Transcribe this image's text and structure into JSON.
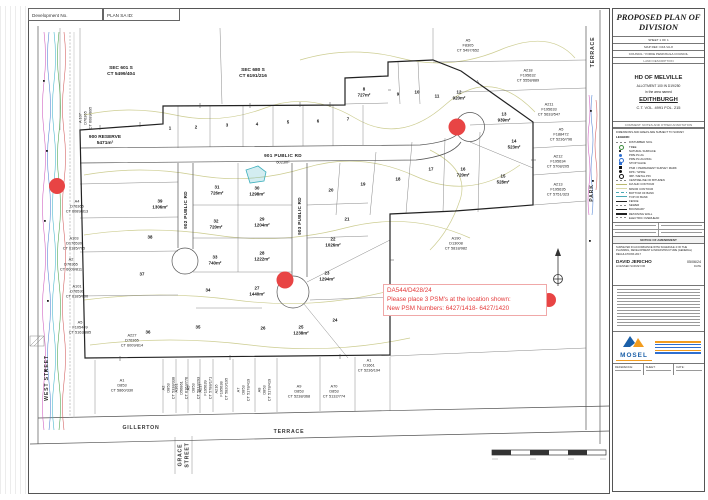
{
  "document": {
    "dev_no_label": "Development No.",
    "plan_sa_id_label": "PLAN SA ID:"
  },
  "annotation": {
    "line1": "DA544/D428/24",
    "line2": "Please place 3 PSM's at the location shown:",
    "line3": "New PSM Numbers: 6427/1418- 6427/1420"
  },
  "colors": {
    "psm_marker_red": "#e84444",
    "water_feature_teal": "#3fb0bd",
    "contour_olive": "#c9c98a",
    "mosel_blue": "#1a5fa8",
    "mosel_orange": "#f29c1f"
  },
  "plan": {
    "sections": {
      "sec601": "SEC 601 S\nCT 5499/404",
      "sec680": "SEC 680 S\nCT 6191/216",
      "reserve": "900 RESERVE\n5471m²",
      "a107": "A 107\nD76365\nCT 6089/895"
    },
    "roads": {
      "r901": "901 PUBLIC RD",
      "r901_area": "6023m²",
      "r902": "902 PUBLIC RD",
      "r903": "903 PUBLIC RD"
    },
    "streets": {
      "west": "WEST STREET",
      "gillerton": "GILLERTON",
      "terrace": "TERRACE",
      "grace": "GRACE\nSTREET",
      "park": "PARK",
      "park_terrace": "TERRACE"
    },
    "lots": [
      "1",
      "2",
      "3",
      "4",
      "5",
      "6",
      "7",
      "8\n727m²",
      "9",
      "10",
      "11",
      "12\n920m²",
      "13\n939m²",
      "14\n523m²",
      "15\n528m²",
      "16\n720m²",
      "17",
      "18",
      "19",
      "20",
      "21",
      "22\n1026m²",
      "23\n1294m²",
      "24",
      "25\n1238m²",
      "26",
      "27\n1440m²",
      "28\n1222m²",
      "29\n1204m²",
      "30\n1298m²",
      "31\n726m²",
      "32\n720m²",
      "33\n740m²",
      "34",
      "35",
      "36",
      "37",
      "38",
      "39\n1306m²"
    ],
    "parcels": {
      "p_a5f8305": "A5\nF8305\nCT 5497/652",
      "p_a218": "A218\nF195632\nCT 5558/889",
      "p_a211": "A211\nF195633\nCT 5633/547",
      "p_a5f188472": "A5\nF188472\nCT 5236/796",
      "p_a212": "A212\nF195634\nCT 5708/205",
      "p_a213": "A213\nF195635\nCT 5751/323",
      "p_a190": "A190\nD13008\nCT 5818/982",
      "p_a4": "A4\nD76365\nCT 6089/813",
      "p_a103": "A103\nD176530\nCT 6185/705",
      "p_a2": "A2\nD76365\nCT 6009/811",
      "p_a101": "A101\nD76530\nCT 6185/700",
      "p_a5f105449": "A5\nF105449\nCT 5163/885",
      "p_a227": "A227\nD76365\nCT 6009/814",
      "b_a1": "A1\nD853\nCT 5860/330",
      "b_a2": "A2\nD853\nCT 5338/338",
      "b_a101": "A101\nD56861\nCT 6163/776",
      "b_a5": "A5\nD853\nCT 5813/293",
      "b_a217": "A217\nF195639\nCT 5788/171",
      "b_a216": "A216\nF195638\nCT 5820/195",
      "b_a7": "A7\nD853\nCT 5178/419",
      "b_a8": "A8\nD853\nCT 5178/419",
      "b_a9": "A9\nD853\nCT 5238/368",
      "b_a70": "A70\nD853\nCT 5132/774",
      "b_a1d1661": "A1\nD1661\nCT 5236/194"
    }
  },
  "titleblock": {
    "title": "PROPOSED PLAN OF DIVISION",
    "sheet_row": "SHEET 1 OF 1",
    "ref_row": "MAP REF: D43-VA-8",
    "council_row": "COUNCIL: YORKE PENINSULA COUNCIL",
    "land_label": "LAND DESCRIPTION",
    "hd": "HD OF MELVILLE",
    "allotment": "ALLOTMENT 100 IN D19/250",
    "named": "in the area named",
    "locality": "EDITHBURGH",
    "ct": "C.T. VOL. 4991 FOL. 215",
    "comment_row": "COMMENT: NOTES AND OTHER ANNOTATION",
    "note": "DIMENSIONS AND AREAS ARE SUBJECT TO SURVEY",
    "legend_label": "LEGEND:",
    "legend": [
      "DISTURBED SOIL",
      "TREE",
      "NATURAL SURFACE",
      "PIPE PLUG",
      "PIPE PLUG RING",
      "STOP VALVE",
      "PSM = PERMANENT SURVEY MARK",
      "DPK / SPIKE",
      "IMP / METAL PIN",
      "CENTRELINE OF BITUMEN",
      "1M AHD CONTOUR",
      "MINOR CONTOUR",
      "BOTTOM OF BANK",
      "TOP OF BANK",
      "FENCE",
      "SEWER",
      "BOUNDARY",
      "RETAINING WALL",
      "ELECTRIC OVERHEAD"
    ],
    "amendment_header": "NOTICE OF AMENDMENT",
    "cert_text": "SURVEYED IN ACCORDANCE WITH SCHEDULE 4 OF THE PLANNING, DEVELOPMENT & INFRASTRUCTURE (GENERAL) REGULATIONS 2017",
    "surveyor": "DAVID JERICHO",
    "survey_date": "05/06/24",
    "surveyor_title": "LICENSED SURVEYOR",
    "date_label": "DATE",
    "mosel": "MOSEL",
    "footer_ref": "REFERENCE:",
    "footer_sheet": "SHEET:",
    "footer_date": "DATE:"
  }
}
